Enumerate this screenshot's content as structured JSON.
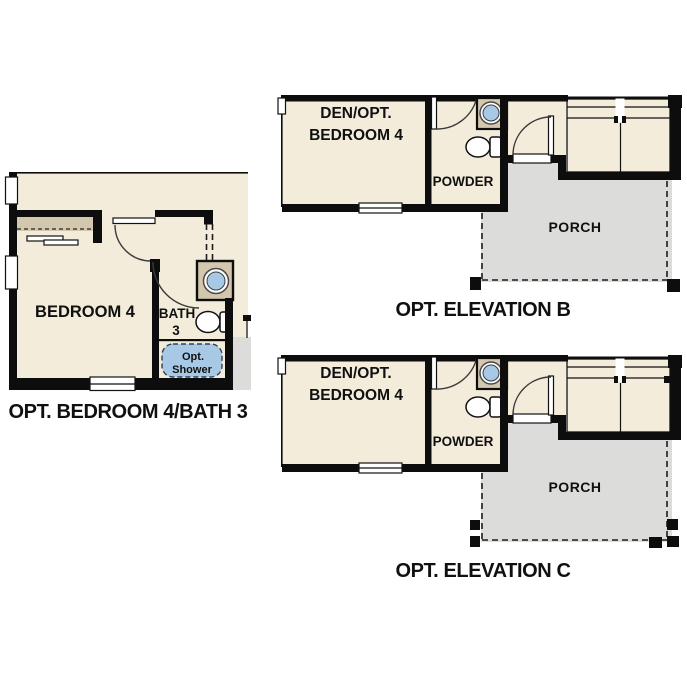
{
  "plans": {
    "bedroom_bath": {
      "title": "OPT. BEDROOM 4/BATH 3",
      "rooms": {
        "bedroom": "BEDROOM 4",
        "bath_line1": "BATH",
        "bath_line2": "3",
        "shower_line1": "Opt.",
        "shower_line2": "Shower"
      }
    },
    "elevation_b": {
      "title": "OPT. ELEVATION B",
      "rooms": {
        "den_line1": "DEN/OPT.",
        "den_line2": "BEDROOM 4",
        "powder": "POWDER",
        "porch": "PORCH"
      }
    },
    "elevation_c": {
      "title": "OPT. ELEVATION C",
      "rooms": {
        "den_line1": "DEN/OPT.",
        "den_line2": "BEDROOM 4",
        "powder": "POWDER",
        "porch": "PORCH"
      }
    }
  },
  "colors": {
    "floor": "#f3ecdb",
    "wall": "#0d0d0d",
    "closet_tan": "#d3c7ae",
    "fixture_blue": "#a7c9e5",
    "porch_gray": "#dcdcda",
    "line": "#1d1d1d"
  }
}
